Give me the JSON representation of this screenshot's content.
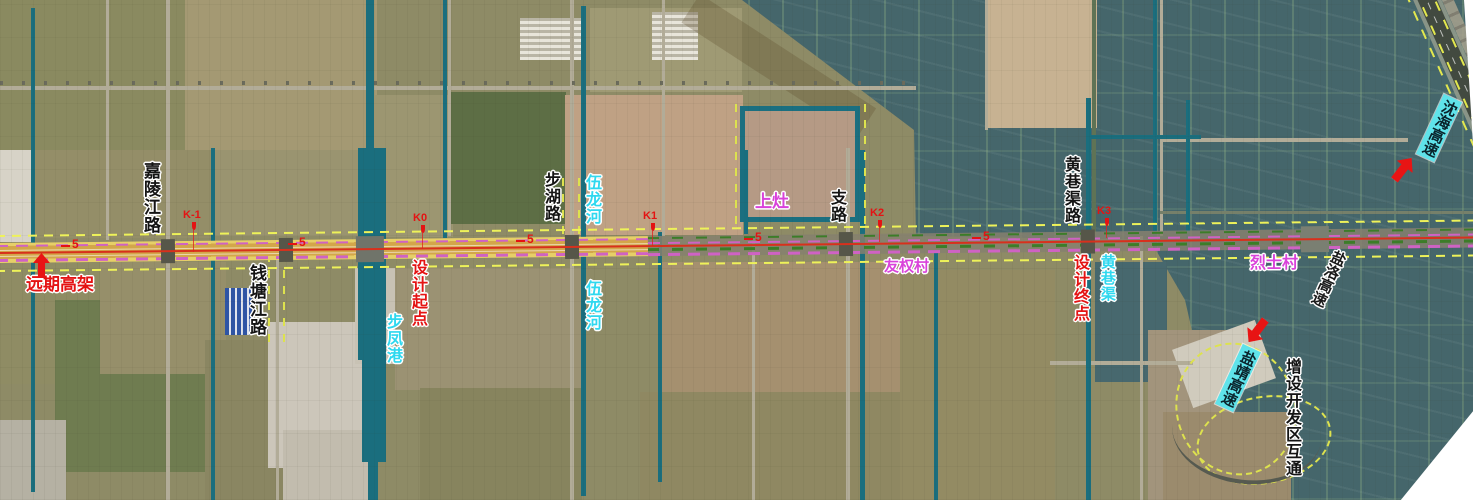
{
  "map": {
    "type": "satellite-road-alignment-plan",
    "colors": {
      "canal_teal": "#1a6e7e",
      "alignment_yellow": "#d3a64a",
      "alignment_centerline_red": "#d8301c",
      "boundary_dash_yellow": "#eef259",
      "water_label_cyan": "#2fd8ef",
      "village_label_magenta": "#d943da",
      "note_red": "#e41313",
      "expressway_tag_bg": "#5fe3ea"
    },
    "labels": {
      "jialingjiang_road": "嘉陵江路",
      "qiantangjiang_road": "钱塘江路",
      "yuanqi_gaojia": "远期高架",
      "sheji_qidian": "设计起点",
      "bufeng_port": "步凤港",
      "buhu_road": "步湖路",
      "wulong_river_north": "伍龙河",
      "wulong_river_south": "伍龙河",
      "shangzao": "上灶",
      "zhi_road": "支路",
      "youquan_village": "友权村",
      "huangxiangqu_road": "黄巷渠路",
      "sheji_zhongdian": "设计终点",
      "huangxiang_canal": "黄巷渠",
      "lieshi_village": "烈士村",
      "shenhai_expressway": "沈海高速",
      "yanluo_expressway": "盐洛高速",
      "yanjing_expressway": "盐靖高速",
      "kaifaqu_hutong": "增设开发区互通"
    },
    "km_markers": {
      "k_minus_1": "K-1",
      "k0": "K0",
      "k1": "K1",
      "k2": "K2",
      "k3": "K3"
    },
    "chainage_markers": {
      "c1": "5",
      "c2": "5",
      "c3": "5",
      "c4": "5",
      "c5": "5"
    }
  }
}
